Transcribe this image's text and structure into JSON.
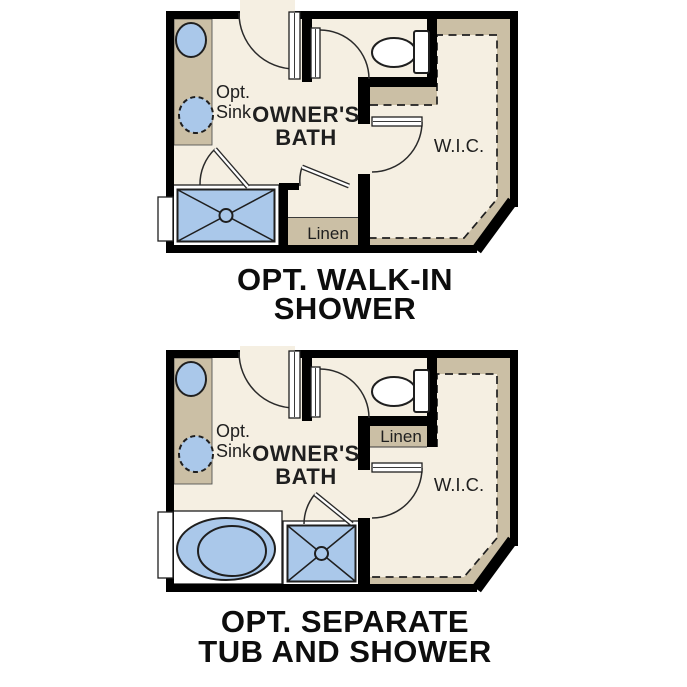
{
  "diagram": {
    "type": "floor-plan-options",
    "background": "#ffffff",
    "colors": {
      "floor": "#f5efe2",
      "walls": "#000000",
      "cabinetry_tan": "#cbbfa5",
      "fixture_blue": "#aac8ea",
      "text": "#1f1f1f"
    },
    "plans": [
      {
        "name": "walk-in-shower-option",
        "caption": {
          "line1": "OPT. WALK-IN",
          "line2": "SHOWER"
        },
        "labels": {
          "opt": "Opt.",
          "sink": "Sink",
          "room_line1": "OWNER'S",
          "room_line2": "BATH",
          "closet": "W.I.C.",
          "linen": "Linen"
        },
        "fixtures": [
          "double-sink-counter",
          "optional-sink",
          "toilet",
          "walk-in-shower",
          "linen-closet",
          "walk-in-closet",
          "window"
        ]
      },
      {
        "name": "separate-tub-and-shower-option",
        "caption": {
          "line1": "OPT. SEPARATE",
          "line2": "TUB AND SHOWER"
        },
        "labels": {
          "opt": "Opt.",
          "sink": "Sink",
          "room_line1": "OWNER'S",
          "room_line2": "BATH",
          "closet": "W.I.C.",
          "linen": "Linen"
        },
        "fixtures": [
          "double-sink-counter",
          "optional-sink",
          "toilet",
          "bathtub",
          "shower",
          "linen-closet",
          "walk-in-closet",
          "window"
        ]
      }
    ]
  }
}
